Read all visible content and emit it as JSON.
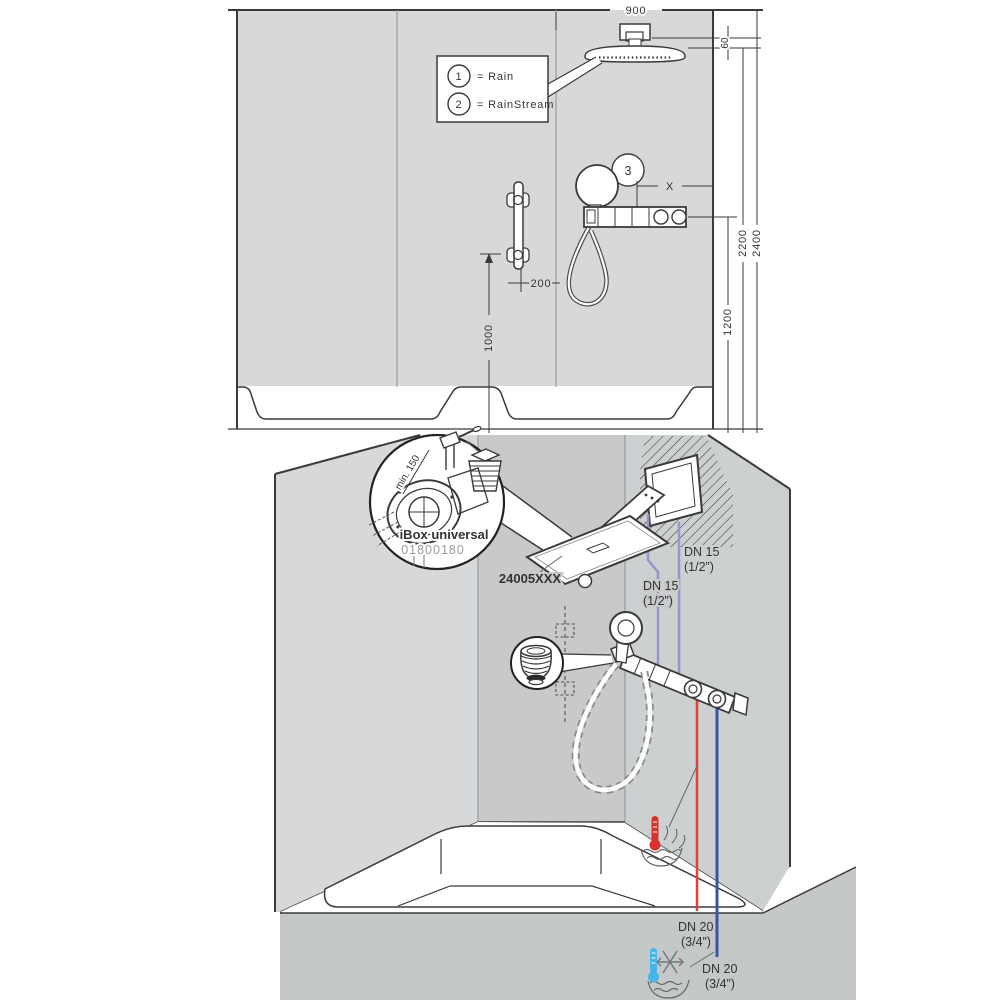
{
  "diagram": {
    "top_view": {
      "legend": {
        "item1_num": "1",
        "item1_label": "= Rain",
        "item2_num": "2",
        "item2_label": "= RainStream"
      },
      "callout_3": "3",
      "dims": {
        "width": "900",
        "head_drop": "60",
        "height_full": "2400",
        "height_head": "2200",
        "height_thermostat": "1200",
        "height_bar": "1000",
        "bar_offset": "200",
        "x_var": "X"
      }
    },
    "bottom_view": {
      "ibox": {
        "title": "iBox universal",
        "code": "01800180",
        "min_depth": "min. 150"
      },
      "product_code": "24005XXX",
      "pipes": {
        "dn15": "DN 15",
        "dn15_size": "(1/2”)",
        "dn20": "DN 20",
        "dn20_size": "(3/4”)"
      }
    },
    "colors": {
      "hot": "#e2403a",
      "cold": "#3a53a4",
      "supply": "#9a94c8",
      "hot_symbol": "#d6332c",
      "cold_symbol": "#45b6e8",
      "wall_light": "#d6d8d9",
      "wall_mid": "#cdd0d1",
      "wall_dark": "#c7c9cb",
      "apron": "#c5c8c9"
    }
  }
}
